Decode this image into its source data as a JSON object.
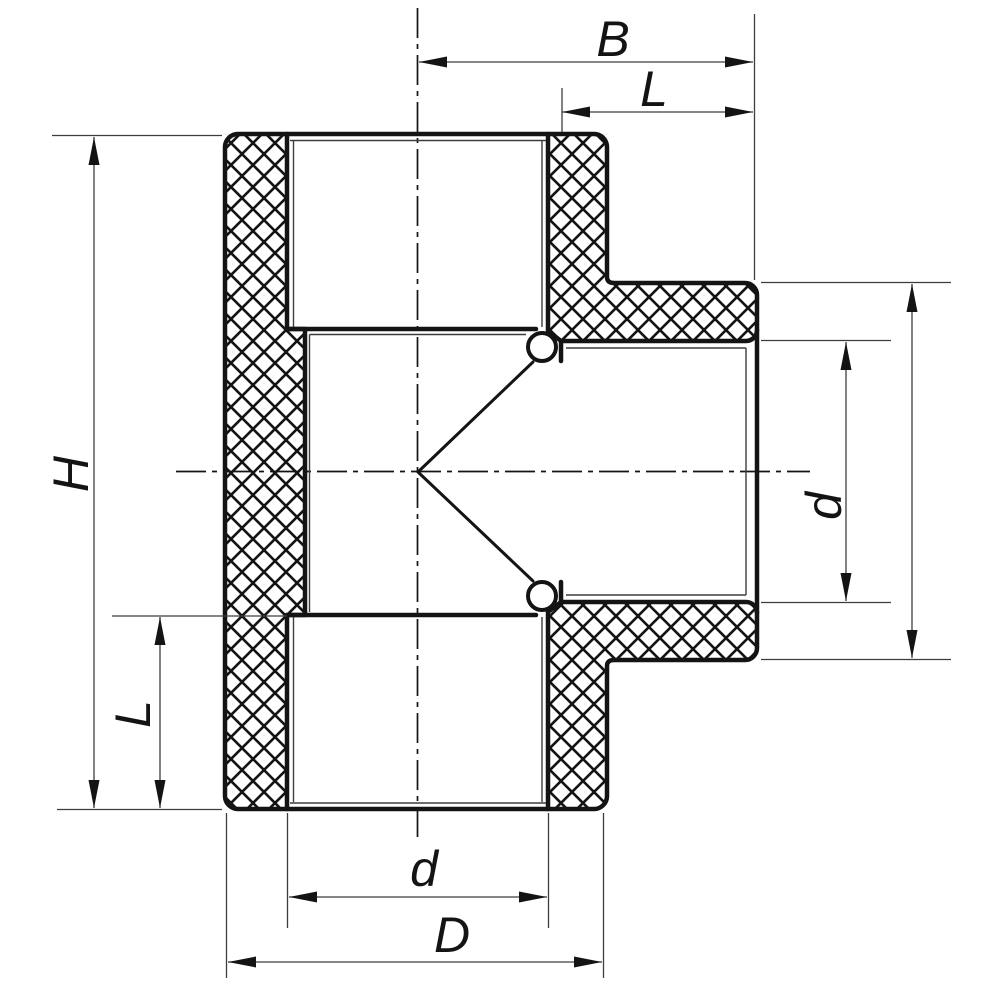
{
  "title": "Sectional technical drawing of an equal tee pipe fitting",
  "colors": {
    "background": "#ffffff",
    "line": "#141414",
    "thin_line": "#3d3d3d"
  },
  "dims": {
    "B": {
      "label": "B"
    },
    "L_top": {
      "label": "L"
    },
    "H": {
      "label": "H"
    },
    "L_bottom": {
      "label": "L"
    },
    "d_branch": {
      "label": "d"
    },
    "branch_outer": {
      "label": ""
    },
    "d_bottom": {
      "label": "d"
    },
    "D": {
      "label": "D"
    }
  }
}
